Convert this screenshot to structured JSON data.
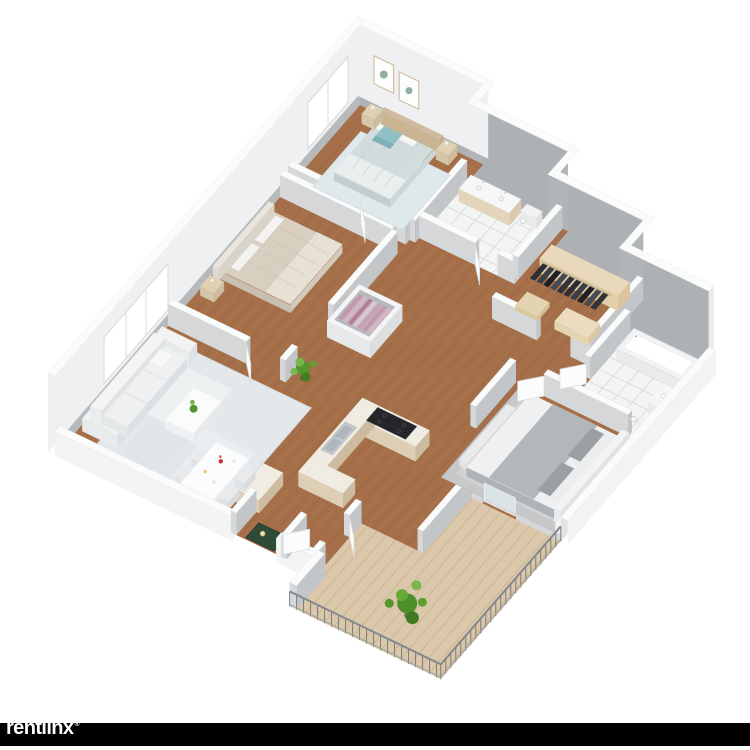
{
  "watermark": {
    "label": "rentlinx",
    "registered_mark": "®"
  },
  "canvas": {
    "background": "#ffffff",
    "bar_color": "#010101",
    "logo_color": "#ffffff"
  },
  "palette": {
    "wall_top": "#fafbfb",
    "wall_inner_nw": "#b7babd",
    "wall_inner_ne": "#aeb1b4",
    "wall_outer": "#eef0f1",
    "wall_side_dark": "#c3c6c8",
    "wall_side_light": "#d5d7d9",
    "wood": "#a56f49",
    "wood_dark": "#8d5a39",
    "wood_light": "#c08a5c",
    "deck": "#dbc8aa",
    "deck_line": "#c6af8c",
    "tile": "#f3f4f4",
    "tile_grout": "#d6d9da",
    "rug_living": "#e4e8eb",
    "rug_bedroom": "#dfe8ea",
    "rug_master": "#c7c8ca",
    "sofa": "#eef0f1",
    "table_white": "#fbfcfd",
    "bed_teal_pillow": "#8fc0c4",
    "bed_teal_blanket": "#d3dcdc",
    "bed_beige": "#d9cfc1",
    "bed_gray_band": "#b4b7ba",
    "bed_white": "#eff0f1",
    "headboard_wood": "#cfbc9e",
    "nightstand_wood": "#e0d0b4",
    "closet_shelf": "#e9d9ba",
    "clothes_dark": "#2b2e34",
    "clothes_pink": "#c795aa",
    "counter_top": "#f0ece1",
    "cabinet_side": "#cdbb9f",
    "stove": "#24262a",
    "sink_steel": "#c3c9ce",
    "fixture_white": "#ffffff",
    "fixture_stroke": "#c9cccd",
    "plant_green": "#55962c",
    "plant_light": "#74b64a",
    "plant_dark": "#447d24",
    "doormat": "#2e4a39",
    "railing": "#70747a",
    "window_white": "#ffffff",
    "art_cactus": "#8fae9b",
    "door_leaf": "#fbfcfc"
  },
  "scene": {
    "view": "isometric-3d-floor-plan",
    "rooms": [
      {
        "id": "bedroom-1",
        "furnishings": [
          "double-bed",
          "teal-accent-pillow",
          "nightstands",
          "cactus-wall-art",
          "area-rug",
          "window"
        ]
      },
      {
        "id": "bathroom-1",
        "furnishings": [
          "double-sink-vanity",
          "toilet",
          "tile-floor"
        ]
      },
      {
        "id": "walk-in-closet",
        "furnishings": [
          "hanging-clothes-dark",
          "wood-shelving"
        ]
      },
      {
        "id": "bathroom-2",
        "furnishings": [
          "bathtub",
          "sink",
          "toilet",
          "tile-floor"
        ]
      },
      {
        "id": "bedroom-2",
        "furnishings": [
          "double-bed-beige",
          "nightstand",
          "window"
        ]
      },
      {
        "id": "wardrobe-closet",
        "furnishings": [
          "hanging-clothes-pink"
        ]
      },
      {
        "id": "hallway",
        "furnishings": [
          "potted-plant"
        ]
      },
      {
        "id": "master-bedroom",
        "furnishings": [
          "double-bed-gray-white",
          "headboard",
          "nightstand",
          "bench",
          "shag-rug"
        ]
      },
      {
        "id": "kitchen",
        "furnishings": [
          "u-shaped-counter",
          "gas-cooktop",
          "double-sink",
          "island-cabinet"
        ]
      },
      {
        "id": "living-room",
        "furnishings": [
          "sofa",
          "coffee-table",
          "area-rug",
          "throw-pillows"
        ]
      },
      {
        "id": "dining-area",
        "furnishings": [
          "dining-table",
          "chairs",
          "red-flowers",
          "plates"
        ]
      },
      {
        "id": "entry",
        "furnishings": [
          "green-doormat"
        ]
      },
      {
        "id": "balcony",
        "furnishings": [
          "wood-deck",
          "metal-railing",
          "potted-plant",
          "sliding-door"
        ]
      }
    ]
  }
}
